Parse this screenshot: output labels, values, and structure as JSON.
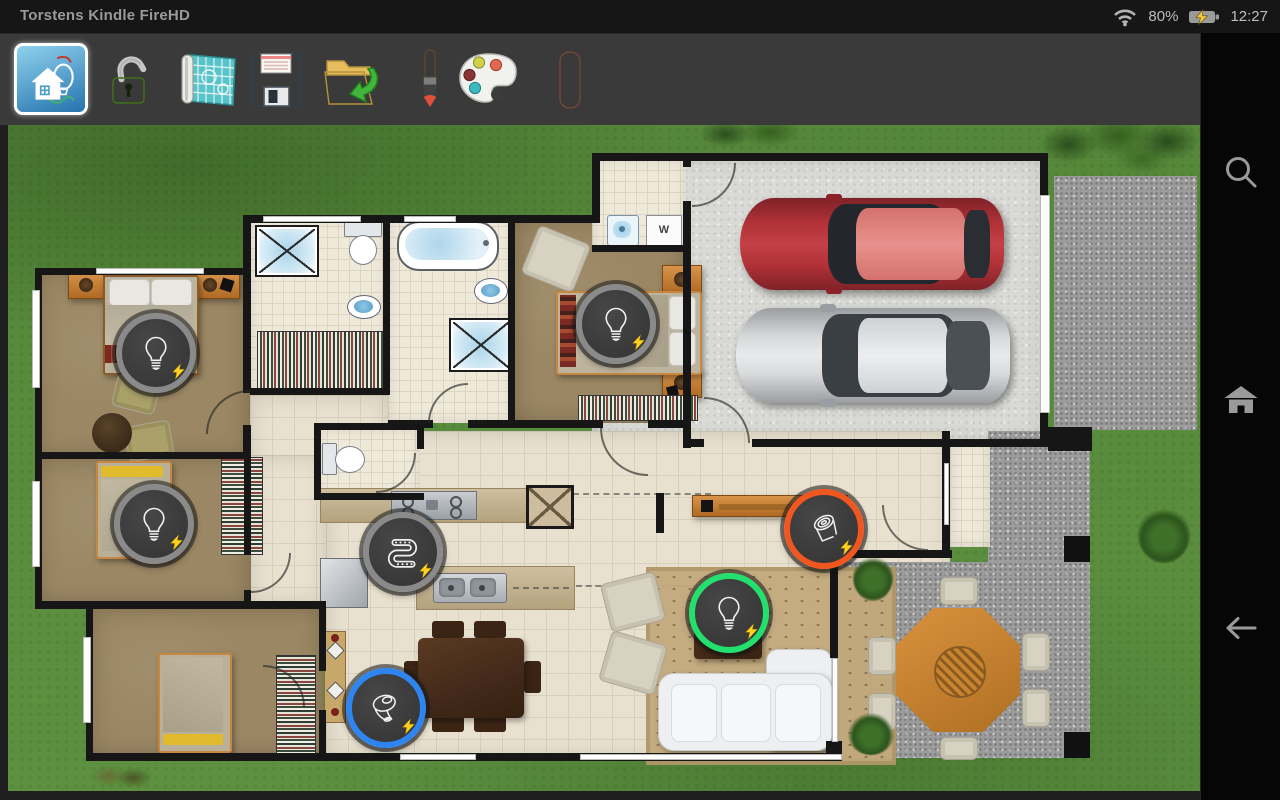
{
  "status_bar": {
    "device_name": "Torstens Kindle FireHD",
    "battery_percent": "80%",
    "time": "12:27",
    "wifi_icon": "wifi-signal",
    "battery_icon": "battery-charging"
  },
  "toolbar": {
    "buttons": [
      {
        "id": "app-home",
        "icon": "hue-house-app",
        "selected": true
      },
      {
        "id": "unlock",
        "icon": "padlock-open",
        "selected": false
      },
      {
        "id": "floorplan",
        "icon": "blueprint",
        "selected": false
      },
      {
        "id": "save",
        "icon": "floppy-disk",
        "selected": false
      },
      {
        "id": "load",
        "icon": "folder-import",
        "selected": false
      },
      {
        "id": "paint",
        "icon": "paint-brush",
        "selected": false
      },
      {
        "id": "palette",
        "icon": "color-palette",
        "selected": false
      },
      {
        "id": "erase",
        "icon": "eraser",
        "selected": false
      }
    ]
  },
  "nav_sidebar": {
    "items": [
      {
        "id": "search",
        "icon": "magnifier"
      },
      {
        "id": "home",
        "icon": "home"
      },
      {
        "id": "back",
        "icon": "arrow-left"
      }
    ]
  },
  "floor_plan": {
    "washer_label": "W",
    "markers": [
      {
        "id": "master-bedroom-light",
        "type": "bulb",
        "ring": "#8a8a8a",
        "x": 142,
        "y": 222,
        "bolt": true
      },
      {
        "id": "bedroom2-light",
        "type": "bulb",
        "ring": "#8a8a8a",
        "x": 140,
        "y": 393,
        "bolt": true
      },
      {
        "id": "guest-bedroom-light",
        "type": "bulb",
        "ring": "#8a8a8a",
        "x": 602,
        "y": 193,
        "bolt": true
      },
      {
        "id": "kitchen-lightstrip",
        "type": "strip",
        "ring": "#8a8a8a",
        "x": 389,
        "y": 421,
        "bolt": true
      },
      {
        "id": "dining-go-light",
        "type": "puck",
        "ring": "#2f85f0",
        "x": 372,
        "y": 577,
        "bolt": true
      },
      {
        "id": "living-room-light",
        "type": "bulb",
        "ring": "#23df6d",
        "x": 715,
        "y": 482,
        "bolt": true
      },
      {
        "id": "console-spot-light",
        "type": "spot",
        "ring": "#f0561f",
        "x": 810,
        "y": 398,
        "bolt": true
      }
    ],
    "colors": {
      "grass": "#5a8d3c",
      "wall": "#161616",
      "tile": "#e9e1cf",
      "bedroom_floor": "#9b8763",
      "concrete": "#d9d9d5",
      "gravel": "#9c9c9c",
      "marker_bg": "#3e3e3e",
      "bolt": "#ffd21f",
      "ring_gray": "#8a8a8a",
      "ring_green": "#23df6d",
      "ring_orange": "#f0561f",
      "ring_blue": "#2f85f0"
    }
  }
}
